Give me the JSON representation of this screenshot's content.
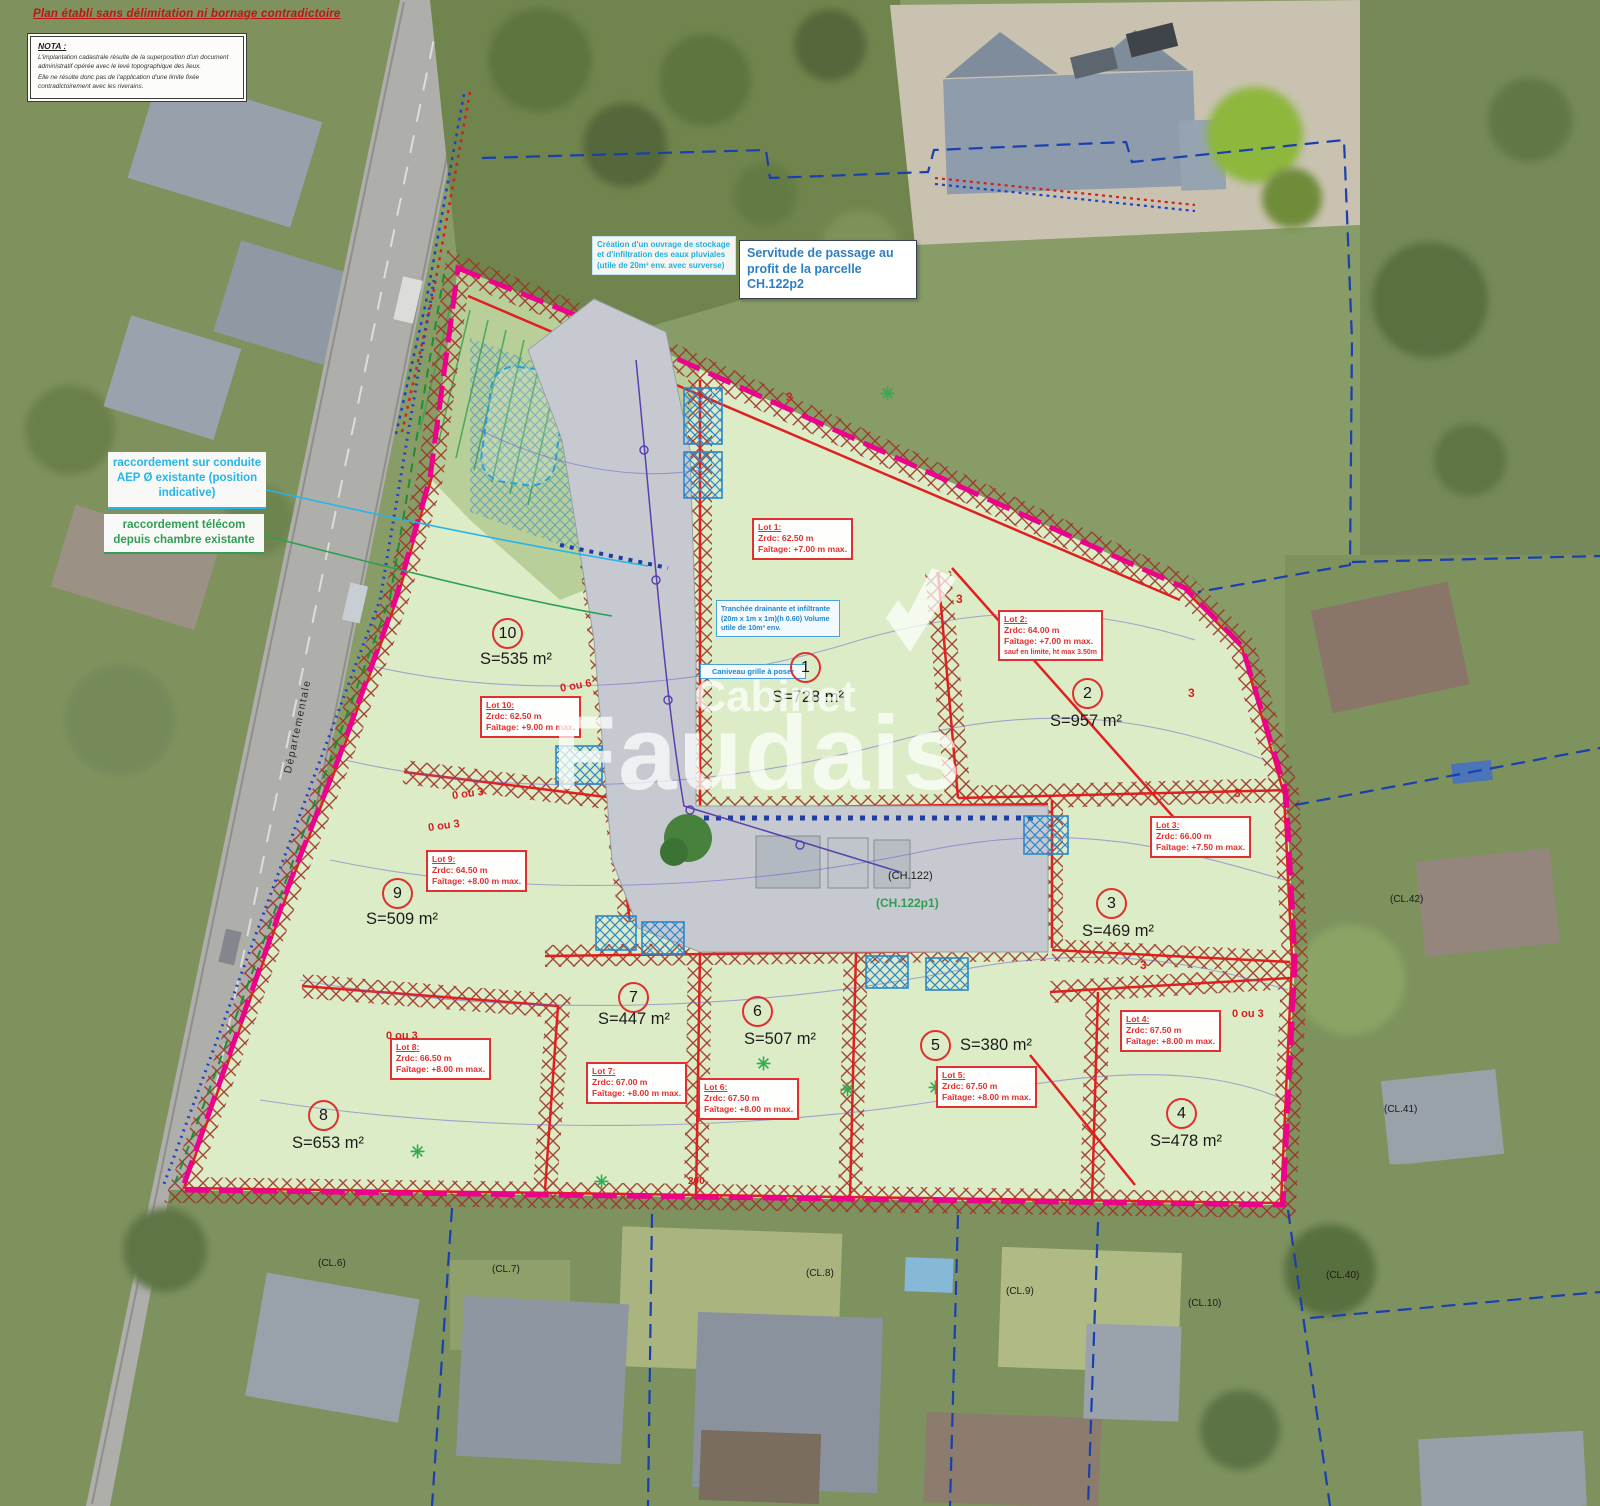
{
  "title": "Plan établi sans délimitation ni bornage contradictoire",
  "nota": {
    "heading": "NOTA :",
    "para1": "L'implantation cadastrale résulte de la superposition d'un document administratif opérée avec le levé topographique des lieux.",
    "para2": "Elle ne résulte donc pas de l'application d'une limite fixée contradictoirement avec les riverains."
  },
  "annotations": {
    "servitude": "Servitude de passage au profit de la parcelle CH.122p2",
    "stockage": "Création d'un ouvrage de stockage et d'infiltration des eaux pluviales (utile de 20m³ env. avec surverse)",
    "aep": "raccordement sur conduite AEP Ø existante (position indicative)",
    "telecom": "raccordement télécom depuis chambre existante",
    "tranchee": "Tranchée drainante et infiltrante (20m x 1m x 1m)(h 0.60) Volume utile de 10m³ env.",
    "caniveau": "Caniveau grille à poser"
  },
  "lots": [
    {
      "num": "1",
      "area": "S=728 m²",
      "label": "Lot 1:",
      "zrdc": "Zrdc: 62.50 m",
      "faitage": "Faîtage: +7.00 m max."
    },
    {
      "num": "2",
      "area": "S=957 m²",
      "label": "Lot 2:",
      "zrdc": "Zrdc: 64.00 m",
      "faitage": "Faîtage: +7.00 m max.",
      "extra": "sauf en limite, ht max 3.50m"
    },
    {
      "num": "3",
      "area": "S=469 m²",
      "label": "Lot 3:",
      "zrdc": "Zrdc: 66.00 m",
      "faitage": "Faîtage: +7.50 m max."
    },
    {
      "num": "4",
      "area": "S=478 m²",
      "label": "Lot 4:",
      "zrdc": "Zrdc: 67.50 m",
      "faitage": "Faîtage: +8.00 m max."
    },
    {
      "num": "5",
      "area": "S=380 m²",
      "label": "Lot 5:",
      "zrdc": "Zrdc: 67.50 m",
      "faitage": "Faîtage: +8.00 m max."
    },
    {
      "num": "6",
      "area": "S=507 m²",
      "label": "Lot 6:",
      "zrdc": "Zrdc: 67.50 m",
      "faitage": "Faîtage: +8.00 m max."
    },
    {
      "num": "7",
      "area": "S=447 m²",
      "label": "Lot 7:",
      "zrdc": "Zrdc: 67.00 m",
      "faitage": "Faîtage: +8.00 m max."
    },
    {
      "num": "8",
      "area": "S=653 m²",
      "label": "Lot 8:",
      "zrdc": "Zrdc: 66.50 m",
      "faitage": "Faîtage: +8.00 m max."
    },
    {
      "num": "9",
      "area": "S=509 m²",
      "label": "Lot 9:",
      "zrdc": "Zrdc: 64.50 m",
      "faitage": "Faîtage: +8.00 m max."
    },
    {
      "num": "10",
      "area": "S=535 m²",
      "label": "Lot 10:",
      "zrdc": "Zrdc: 62.50 m",
      "faitage": "Faîtage: +9.00 m max."
    }
  ],
  "parcels": {
    "ch122": "(CH.122)",
    "ch122p1": "(CH.122p1)",
    "cl6": "(CL.6)",
    "cl7": "(CL.7)",
    "cl8": "(CL.8)",
    "cl9": "(CL.9)",
    "cl10": "(CL.10)",
    "cl40": "(CL.40)",
    "cl41": "(CL.41)",
    "cl42": "(CL.42)"
  },
  "setbacks": {
    "s1": "0 ou 3",
    "s2": "0 ou 3",
    "s3": "0 ou 3",
    "s4": "0 ou 3",
    "s5": "0 ou 6",
    "dim3": "3",
    "dim200": "200"
  },
  "road_label": "Départementale",
  "watermark": {
    "line1": "Cabinet",
    "line2": "Faudais"
  },
  "colors": {
    "site": "#dcecc6",
    "hatch": "#9c3424",
    "lot_line": "#e02020",
    "boundary_magenta": "#ec008c",
    "cadastral_blue": "#1a3fae",
    "water_cyan": "#25b5e8",
    "telecom_green": "#2f9e53"
  }
}
